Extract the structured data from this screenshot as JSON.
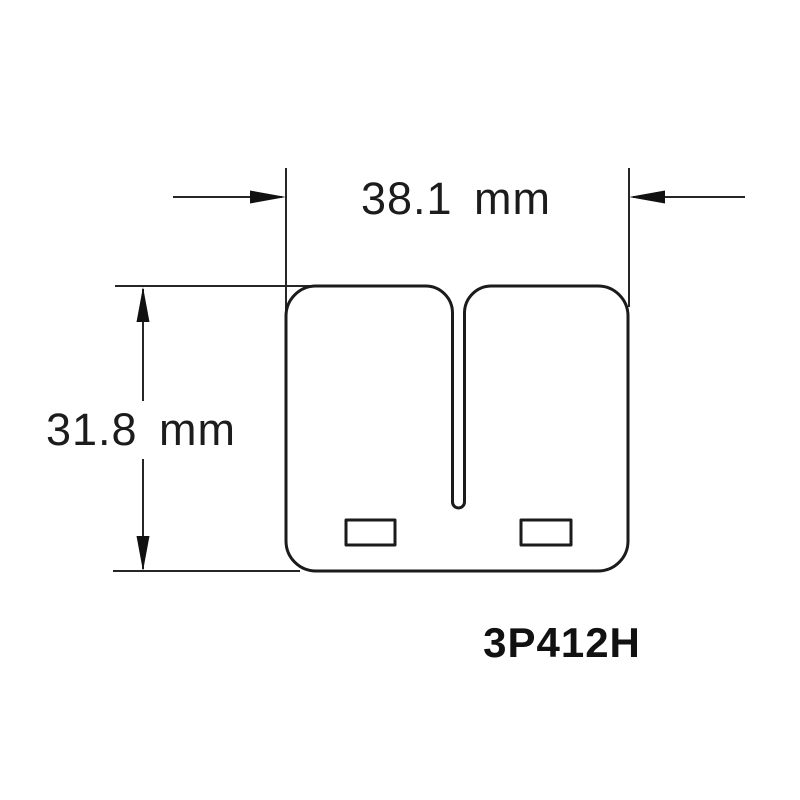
{
  "page": {
    "background_color": "#ffffff",
    "line_color": "#1b1b1b",
    "text_color": "#1c1c1c"
  },
  "drawing": {
    "type": "technical-dimension-drawing",
    "part_number": "3P412H",
    "dimensions": {
      "width": {
        "label": "38.1 mm",
        "value": 38.1,
        "unit": "mm"
      },
      "height": {
        "label": "31.8 mm",
        "value": 31.8,
        "unit": "mm"
      }
    }
  }
}
